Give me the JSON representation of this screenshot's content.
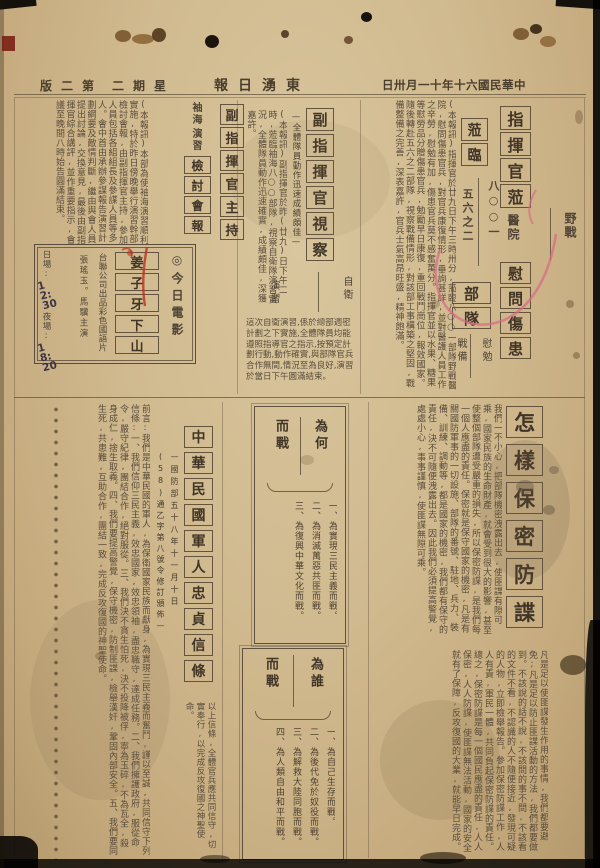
{
  "masthead": {
    "date": "日卅月一十年十六國民華中",
    "paper_name": "報日湧東",
    "weekday": "二期星",
    "page": "版二第"
  },
  "top": {
    "commander_visit": {
      "headline": "指揮官蒞",
      "headline2": "蒞臨",
      "unit_right": "八○○一",
      "unit_left": "五六之二",
      "place_right": "野戰",
      "place_left": "醫院",
      "headline3": "慰問傷患",
      "unit_boxes": "部隊",
      "tag_right": "慰勉",
      "tag_left": "戰備",
      "body": "(本報訊)指揮官於廿九日下午三時卅分,蒞臨八○○一部隊野戰醫院,慰問傷患官兵,對官兵康復情形,垂詢甚詳,並對醫護人員工作之辛勞,慰勉有加,傷患官兵莫不感奮萬分。指揮官並以水果、糖果等慰勞品分贈傷患官兵,勉勵早日康復,重回戰鬥崗位,報效國家。隨後轉赴五六之二部隊,視察戰備情形,對該部工事構築之堅固,戰備整備之完善,深表嘉許,官兵士氣高昂旺盛,精神飽滿。"
    },
    "deputy_inspection": {
      "headline": "副指揮官視察",
      "side_note": "—全體隊員動作迅速成績頗佳—",
      "tag_right": "自衛",
      "tag_left": "演習",
      "body": "(本報訊)副指揮官於昨(廿九)日下午二時,蒞臨袖海八○○部隊,視察自衛隊演習實況,全體隊員動作迅速確實,成績頗佳,深獲嘉許。",
      "body2": "這次自衛演習,係於總部週密計劃之下實施,全體隊員均能遵照指導官之指示,按預定計劃行動,動作確實,與部隊官兵合作無間,情況至為良好,演習於當日下午圓滿結束。"
    },
    "exercise_review": {
      "tag_top": "袖海",
      "tag_bottom": "演習",
      "headline_small": "檢討會報",
      "headline": "副指揮官主持",
      "body": "(本報訊)本部為使袖海演習順利實施,特於昨日傍晚舉行演習幹部檢討會報,由副指揮官主持,參加人員包括各組組長及參謀人員等多人。會中首由承辦參謀報告演習計劃綱要及敵情判斷,繼由與會人員提出討論,交換意見,最後由副指揮官綜合講評,並作重要指示,會議至晚間八時始告圓滿結束。"
    },
    "movie_box": {
      "label": "◎今日電影",
      "title": "姜子牙下山",
      "company": "台聯公司出品彩色國語片",
      "cast": "張瑤玉。馬驥主演",
      "day_label": "日場:",
      "day_time": "12:30",
      "night_label": "夜場:",
      "night_time": "18:20"
    }
  },
  "bottom": {
    "security": {
      "headline": "怎樣保密防諜",
      "body1": "我們一不小心,把部隊機密洩露出去,使匪諜有隙可乘,國家民族的生命財產,就會受到很大的影響,甚至使整個部隊遭受嚴重的損失,所以保密防諜,是我們每一個人應盡的責任。保密就是保守國家的機密,凡是有關國防軍事的一切設施、部隊的番號、駐地、兵力、裝備、訓練、調動等,都是國家的機密,我們都有保守的責任,決不可隨便洩露出去。因此我們必須提高警覺,處處小心,事事謹慎,使匪諜無隙可乘。",
      "body2": "凡是足以使匪諜發生作用的事情,我們都要避免;凡是足以防止匪諜活動的方法,我們都要做到。不該說的話不說,不該問的事不問,不該看的文件不看,不認識的人不隨便接近,發現可疑的人物,立即檢舉報告。參加保密防諜工作,人人有責,軍民一體,共同負起保密防諜的責任。總之,保密防諜是每一個國民應盡的責任,人人保密,人人防諜,使匪諜無法活動,國家的安全就有了保障,反攻復國的大業,就能早日完成。"
    },
    "why_fight": {
      "header_right": "為何",
      "header_left": "而戰",
      "items": [
        "一、為實現三民主義而戰。",
        "二、為消滅萬惡共匪而戰。",
        "三、為復興中華文化而戰。"
      ]
    },
    "whom_fight": {
      "header_right": "為誰",
      "header_left": "而戰",
      "items": [
        "一、為自己生存而戰。",
        "二、為後代免於奴役而戰。",
        "三、為解救大陸同胞而戰。",
        "四、為人類自由和平而戰。"
      ]
    },
    "creed": {
      "headline": "中華民國軍人忠貞信條",
      "subtitle_right": "—國防部五十八年十一月十日",
      "subtitle_left": "(58)通乙字第八號令修訂頒佈—",
      "body": "前言:我們是中華民國的軍人,為保衛國家民族而獻身,為實現三民主義而奮鬥,謹以至誠,共同信守下列信條:一、我們信仰三民主義,效忠國家,效忠領袖,盡忠職守,達成任務。二、我們擁護政府,服從命令,嚴守紀律,團結合作,絕對服從。三、我們決不貪生怕死,決不投降被俘,寧為玉碎,不為瓦全,殺身成仁,捨生取義。四、我們要提高警覺,保守機密,防制匪諜,檢舉漢奸,鞏固內部安全。五、我們要同生死,共患難,互助合作,團結一致,完成反攻復國的神聖使命。",
      "note": "以上信條,全體官兵應共同信守,切實奉行,以完成反攻復國之神聖使命。"
    }
  },
  "colors": {
    "paper": "#cfb78d",
    "ink": "#4f4436",
    "red_pen": "#d96a85",
    "handwriting": "#3c3547"
  }
}
